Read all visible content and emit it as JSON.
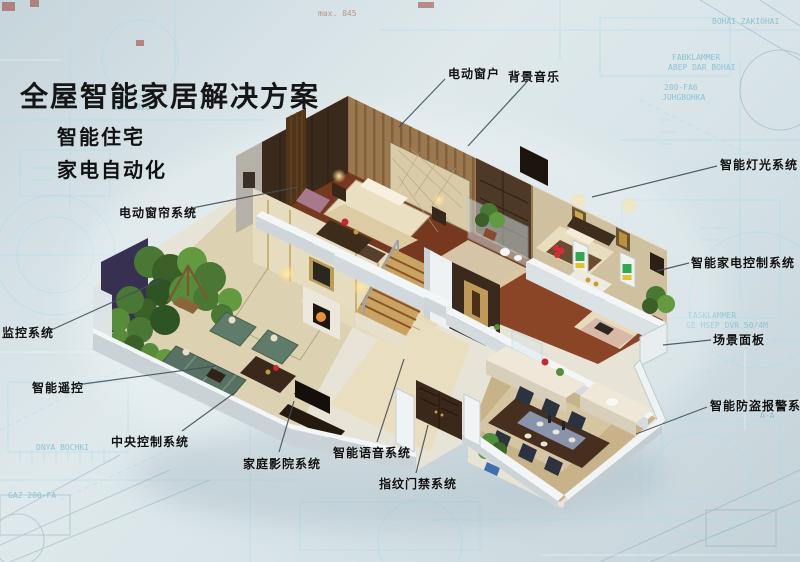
{
  "poster": {
    "title": "全屋智能家居解决方案",
    "subtitle_line1": "智能住宅",
    "subtitle_line2": "家电自动化"
  },
  "callouts": [
    {
      "id": "electric-window",
      "text": "电动窗户"
    },
    {
      "id": "background-music",
      "text": "背景音乐"
    },
    {
      "id": "smart-lighting-system",
      "text": "智能灯光系统"
    },
    {
      "id": "smart-appliance-control-system",
      "text": "智能家电控制系统"
    },
    {
      "id": "scene-panel",
      "text": "场景面板"
    },
    {
      "id": "smart-burglar-alarm-system",
      "text": "智能防盗报警系统"
    },
    {
      "id": "electric-curtain-system",
      "text": "电动窗帘系统"
    },
    {
      "id": "monitoring-system",
      "text": "监控系统"
    },
    {
      "id": "smart-remote-control",
      "text": "智能遥控"
    },
    {
      "id": "central-control-system",
      "text": "中央控制系统"
    },
    {
      "id": "home-theater-system",
      "text": "家庭影院系统"
    },
    {
      "id": "smart-voice-system",
      "text": "智能语音系统"
    },
    {
      "id": "fingerprint-access-system",
      "text": "指纹门禁系统"
    }
  ],
  "illustration": {
    "name": "smart-home-isometric-cutaway"
  },
  "background_texts": [
    "max. 845",
    "min. 820",
    "BOHAI ZAKIOHAI",
    "FABKLAMMER",
    "ABEP DAR BOHAI",
    "200-FA6",
    "JUHGBOHKA",
    "FASKLAMMER",
    "GE HSEP DVR 50/4M",
    "A-A",
    "DNYA BOCHKI",
    "GAZ 200-FA"
  ],
  "colors": {
    "label_text": "#151515",
    "leader_line": "#44505a",
    "blueprint_line": "#a9dcec",
    "background": "#d3e0e5"
  }
}
